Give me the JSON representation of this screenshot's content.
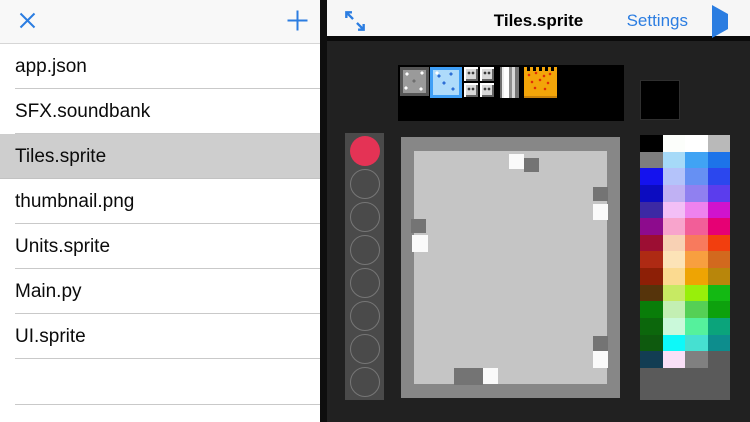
{
  "left_panel": {
    "files": [
      "app.json",
      "SFX.soundbank",
      "Tiles.sprite",
      "thumbnail.png",
      "Units.sprite",
      "Main.py",
      "UI.sprite"
    ],
    "selected_file": "Tiles.sprite"
  },
  "right_panel": {
    "header": {
      "title": "Tiles.sprite",
      "settings_label": "Settings"
    },
    "sprite_strip": {
      "tiles": [
        "stone-block",
        "ice-block",
        "vent-blocks",
        "pillar-block",
        "lava-block"
      ],
      "selected_tile": "ice-block"
    },
    "preview_color": "#000000",
    "tool_slots": [
      "#e43355",
      null,
      null,
      null,
      null,
      null,
      null,
      null
    ],
    "canvas": {
      "base_color": "#c5c5c5",
      "border_color": "#878787",
      "pixel_colors": {
        "light": "#fafafa",
        "dark": "#747474"
      },
      "pixels": [
        {
          "x": 108,
          "y": 17,
          "w": 15,
          "h": 15,
          "tone": "light"
        },
        {
          "x": 123,
          "y": 21,
          "w": 15,
          "h": 14,
          "tone": "dark"
        },
        {
          "x": 192,
          "y": 50,
          "w": 15,
          "h": 14,
          "tone": "dark"
        },
        {
          "x": 192,
          "y": 67,
          "w": 15,
          "h": 16,
          "tone": "light"
        },
        {
          "x": 10,
          "y": 82,
          "w": 15,
          "h": 14,
          "tone": "dark"
        },
        {
          "x": 11,
          "y": 98,
          "w": 16,
          "h": 17,
          "tone": "light"
        },
        {
          "x": 192,
          "y": 199,
          "w": 15,
          "h": 15,
          "tone": "dark"
        },
        {
          "x": 192,
          "y": 214,
          "w": 15,
          "h": 17,
          "tone": "light"
        },
        {
          "x": 53,
          "y": 231,
          "w": 29,
          "h": 17,
          "tone": "dark"
        },
        {
          "x": 82,
          "y": 231,
          "w": 15,
          "h": 16,
          "tone": "light"
        }
      ]
    },
    "palette": {
      "rows": [
        [
          "#000000",
          "#fcfefb",
          "#ffffff",
          "#b9b9b9"
        ],
        [
          "#7e7e7e",
          "#a6daf8",
          "#40a3f4",
          "#1d73e9"
        ],
        [
          "#1412ee",
          "#b4c3fa",
          "#6690f3",
          "#2b47ee"
        ],
        [
          "#0c0cc0",
          "#c0b1f3",
          "#9080f0",
          "#5b3ded"
        ],
        [
          "#3c29a4",
          "#f3bff6",
          "#ee82ee",
          "#d013cd"
        ],
        [
          "#8d0b8d",
          "#f8a4cc",
          "#f25e98",
          "#e60074"
        ],
        [
          "#9c0e33",
          "#f8d1b4",
          "#f87a5d",
          "#f23e0e"
        ],
        [
          "#ae2a13",
          "#fce3b7",
          "#f89f3f",
          "#d2691e"
        ],
        [
          "#8d1f06",
          "#fbda90",
          "#eea403",
          "#b8860b"
        ],
        [
          "#56340b",
          "#c7ea63",
          "#98ef0a",
          "#13b913"
        ],
        [
          "#097d09",
          "#c3efb3",
          "#55d055",
          "#0da10d"
        ],
        [
          "#0c670c",
          "#caf9da",
          "#55f19c",
          "#0ba47b"
        ],
        [
          "#0e5a0e",
          "#0df9f9",
          "#46e0d1",
          "#0d8d8d"
        ],
        [
          "#123d53",
          "#f9e0f7",
          "#808080",
          null
        ]
      ]
    }
  },
  "colors": {
    "accent_blue": "#2b7de1",
    "active_tool": "#e43355",
    "selected_row_bg": "#cecece"
  }
}
